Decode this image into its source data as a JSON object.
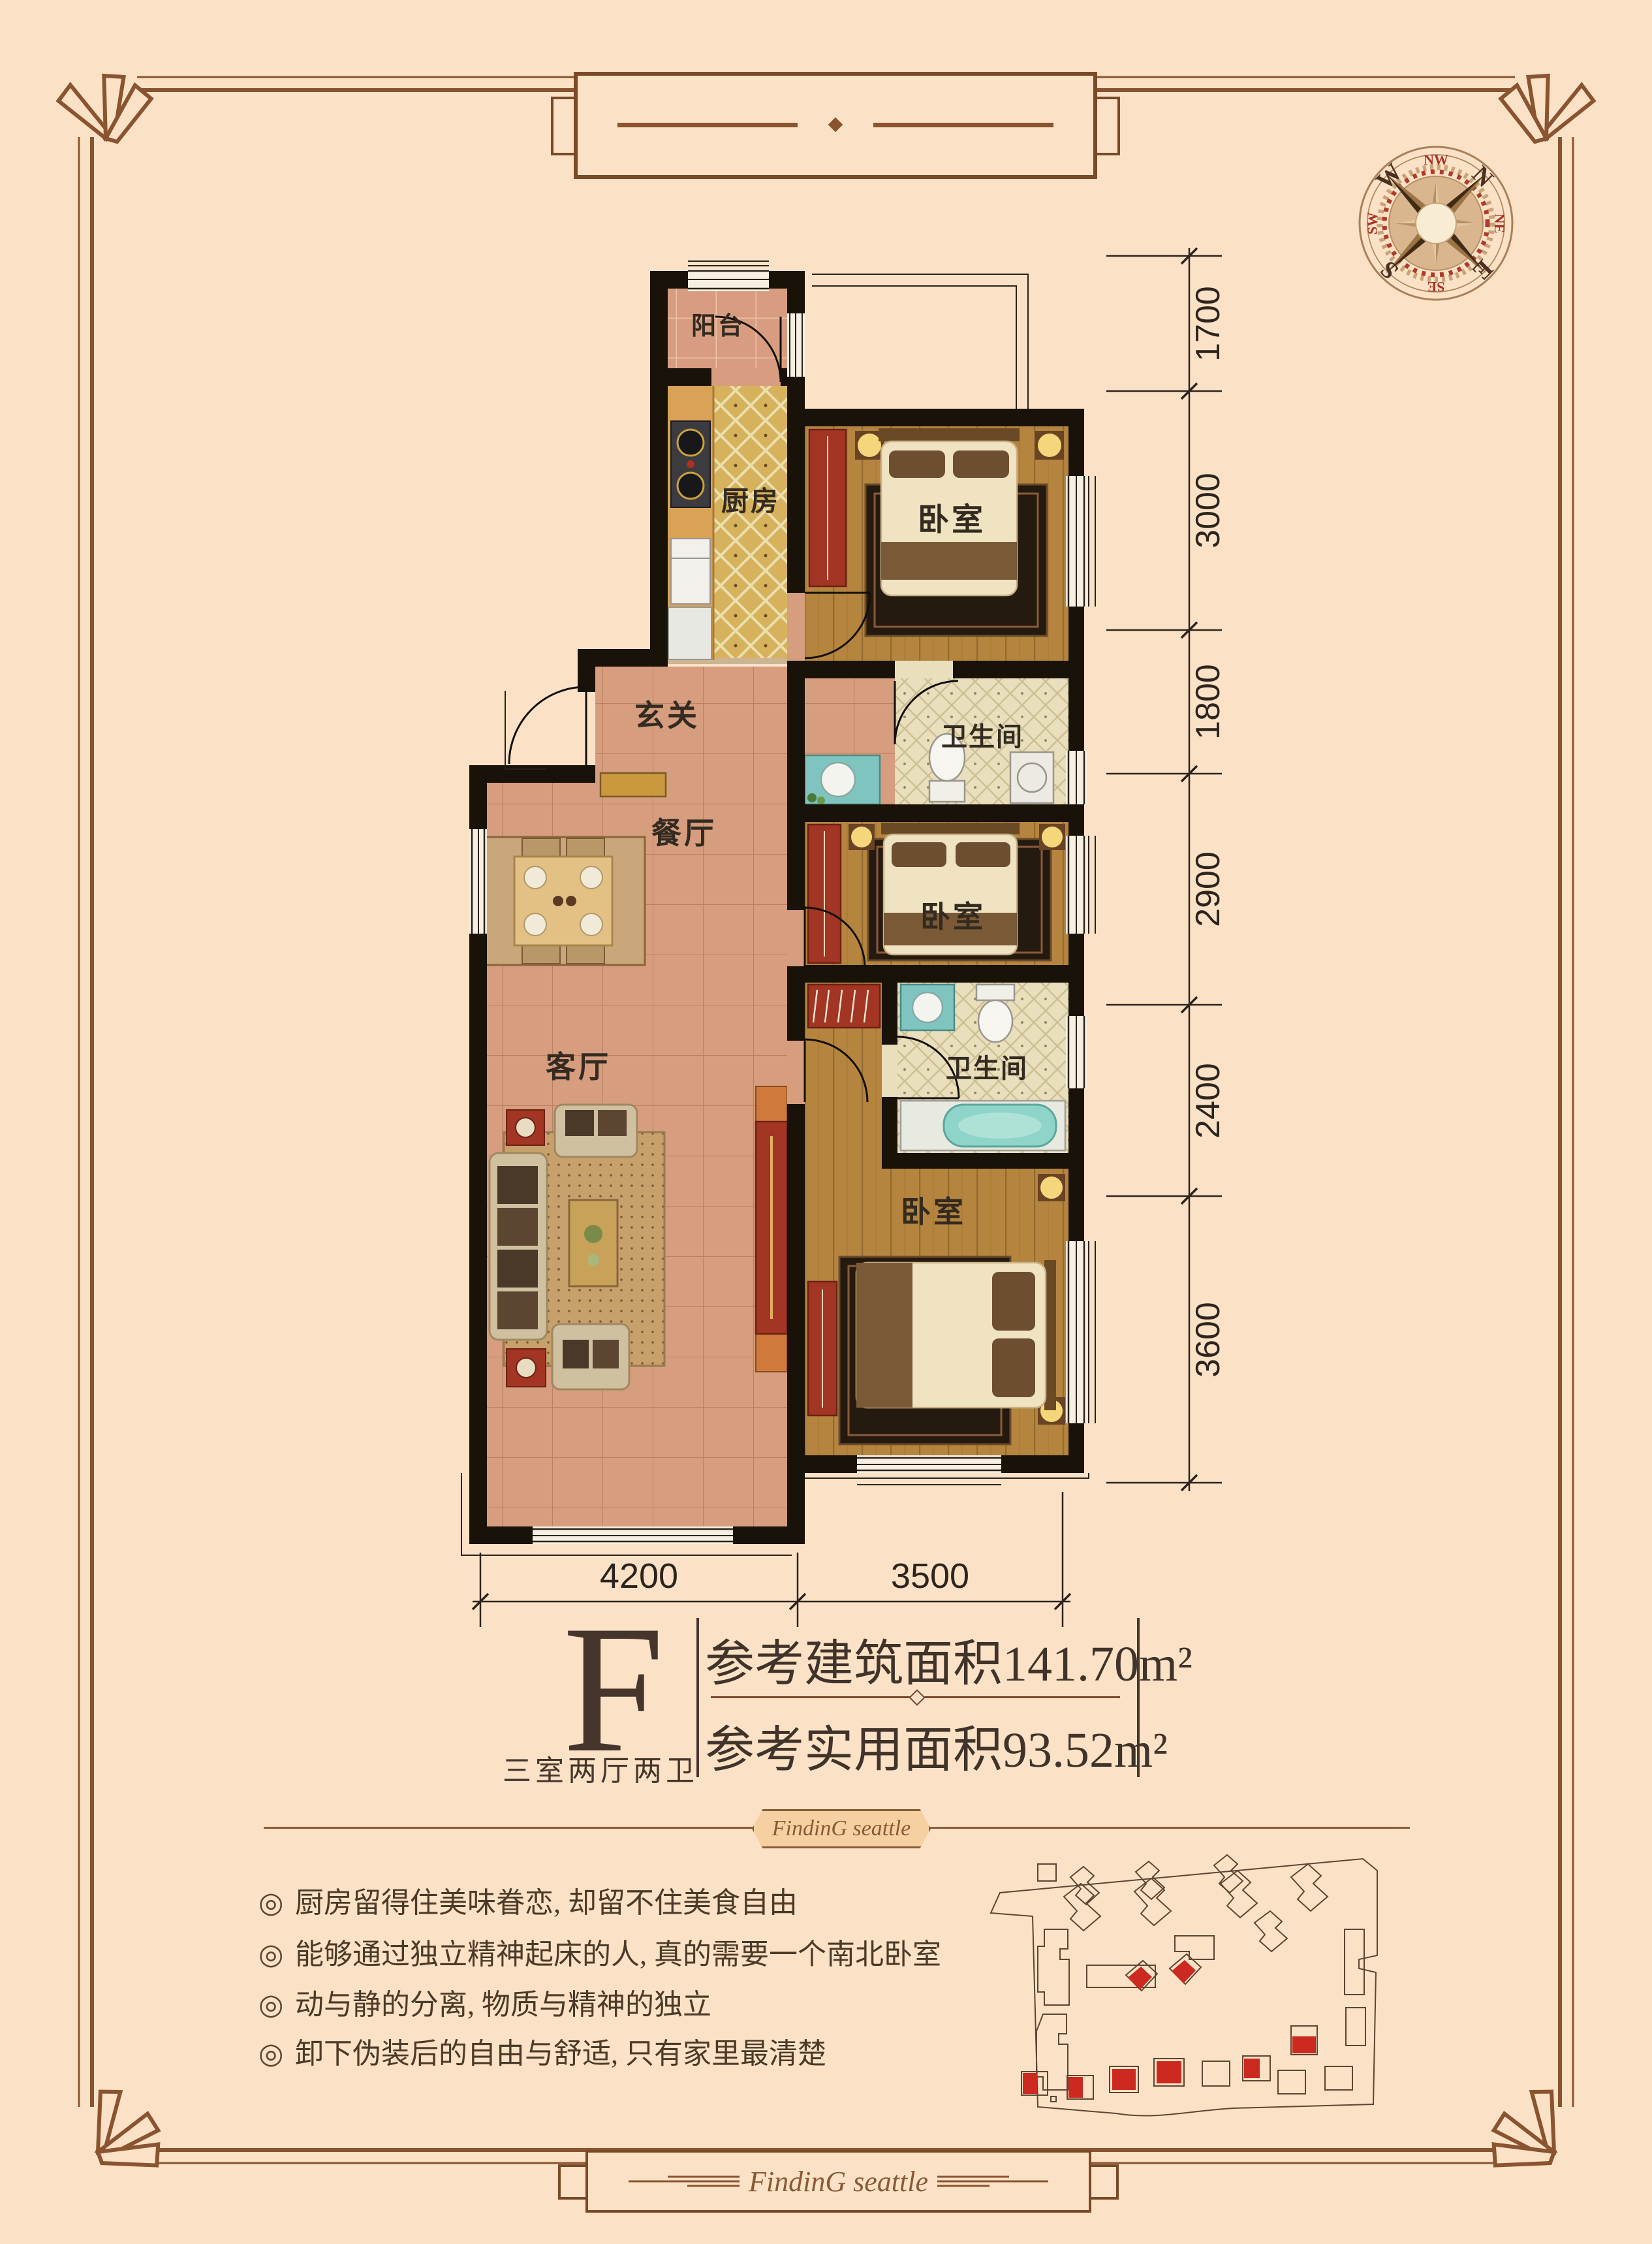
{
  "meta": {
    "bg_color": "#fbe2c6",
    "frame_color": "#815229",
    "accent_red": "#b43527",
    "ink_color": "#3a2d22"
  },
  "compass": {
    "cardinals": {
      "n": "N",
      "e": "E",
      "s": "S",
      "w": "W"
    },
    "intercardinals": {
      "nw": "NW",
      "ne": "NE",
      "se": "SE",
      "sw": "SW"
    }
  },
  "plan": {
    "rooms": {
      "balcony": "阳台",
      "kitchen": "厨房",
      "bedroom_top": "卧室",
      "bath_top": "卫生间",
      "foyer": "玄关",
      "dining": "餐厅",
      "bedroom_mid": "卧室",
      "living": "客厅",
      "bath_low": "卫生间",
      "bedroom_low": "卧室"
    },
    "dims_right": [
      "1700",
      "3000",
      "1800",
      "2900",
      "2400",
      "3600"
    ],
    "dims_bottom": [
      "4200",
      "3500"
    ]
  },
  "unit": {
    "letter": "F",
    "layout": "三室两厅两卫",
    "gross_area": "参考建筑面积141.70m²",
    "net_area": "参考实用面积93.52m²"
  },
  "selling_points": {
    "marker": "◎",
    "items": [
      "厨房留得住美味眷恋, 却留不住美食自由",
      "能够通过独立精神起床的人, 真的需要一个南北卧室",
      "动与静的分离, 物质与精神的独立",
      "卸下伪装后的自由与舒适, 只有家里最清楚"
    ]
  },
  "brand": {
    "script": "FindinG seattle"
  }
}
